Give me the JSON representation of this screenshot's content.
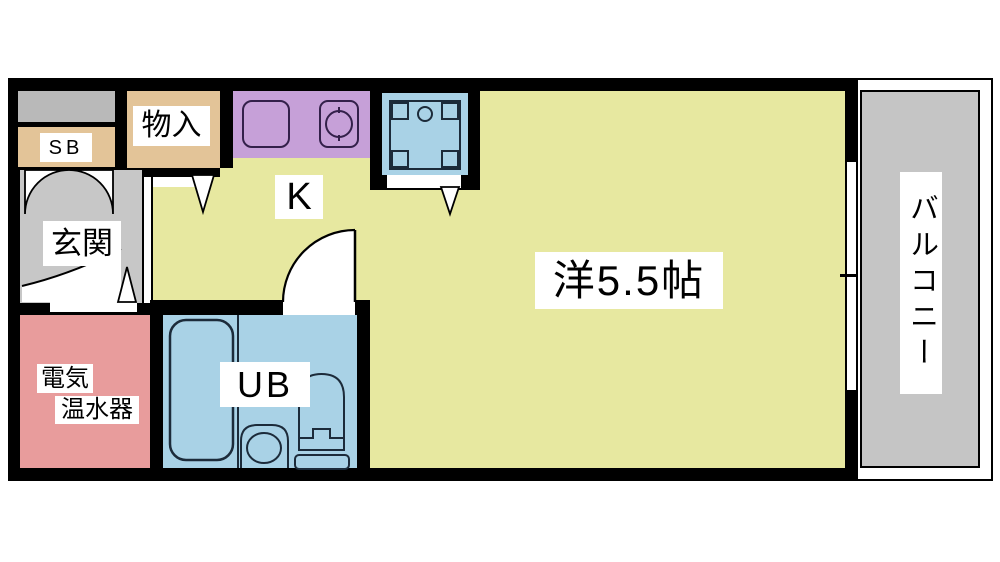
{
  "plan": {
    "title": "studio-apartment-floorplan",
    "labels": {
      "storage": "物入",
      "shoe_box": "SB",
      "entrance": "玄関",
      "kitchen": "K",
      "unit_bath": "UB",
      "water_heater_line1": "電気",
      "water_heater_line2": "温水器",
      "main_room": "洋5.5帖",
      "balcony": "バルコニー"
    },
    "colors": {
      "wall": "#000000",
      "room_yellow": "#e7e8a0",
      "counter_purple": "#c6a0d8",
      "wet_blue": "#a9d2e6",
      "heater_pink": "#e89c9c",
      "closet_tan": "#e3c498",
      "entrance_gray": "#c7c7c7",
      "balcony_gray": "#c5c5c5",
      "meter_gray": "#b9b9b9",
      "fixture_line": "#1c2b3a",
      "door_swing_fill": "#ffffff"
    },
    "symbols": [
      "kitchen-sink-icon",
      "stove-burner-icon",
      "washing-machine-pan-icon",
      "bathtub-icon",
      "toilet-icon",
      "washbasin-icon",
      "hinged-door-icon",
      "double-closet-door-icon",
      "opening-marker-triangle-icon",
      "window-icon"
    ]
  }
}
